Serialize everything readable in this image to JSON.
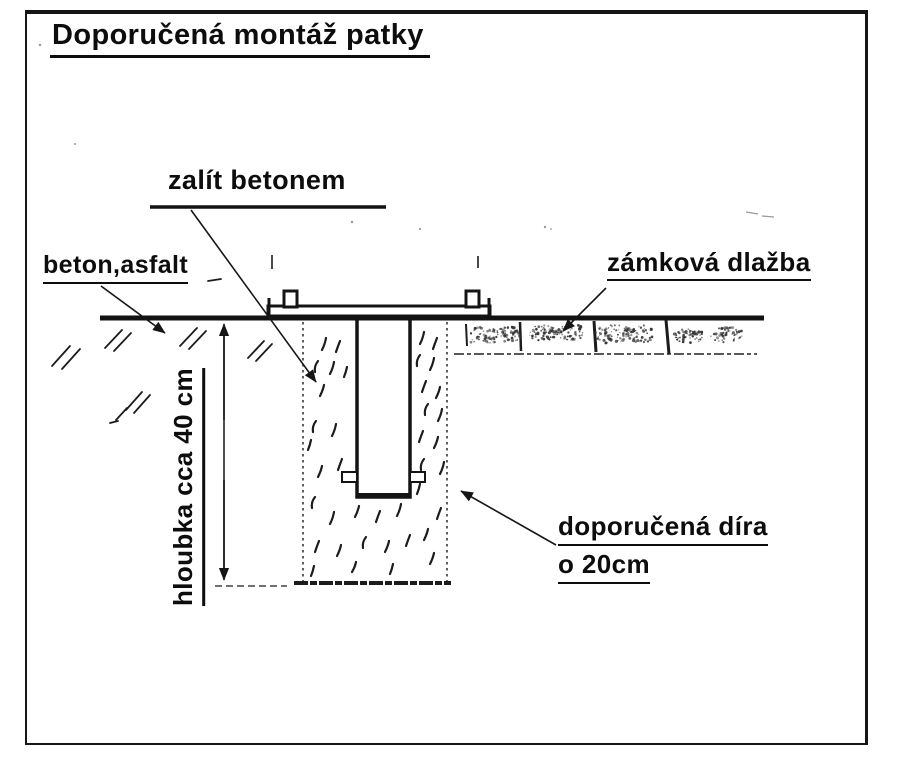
{
  "title": "Doporučená montáž patky",
  "labels": {
    "pour_concrete": "zalít betonem",
    "concrete_asphalt": "beton,asfalt",
    "interlocking_paving": "zámková dlažba",
    "depth": "hloubka cca 40 cm",
    "recommended_hole_line1": "doporučená díra",
    "recommended_hole_line2": "o 20cm"
  },
  "colors": {
    "ink": "#161616",
    "paper": "#ffffff",
    "speckle": "#333333"
  }
}
